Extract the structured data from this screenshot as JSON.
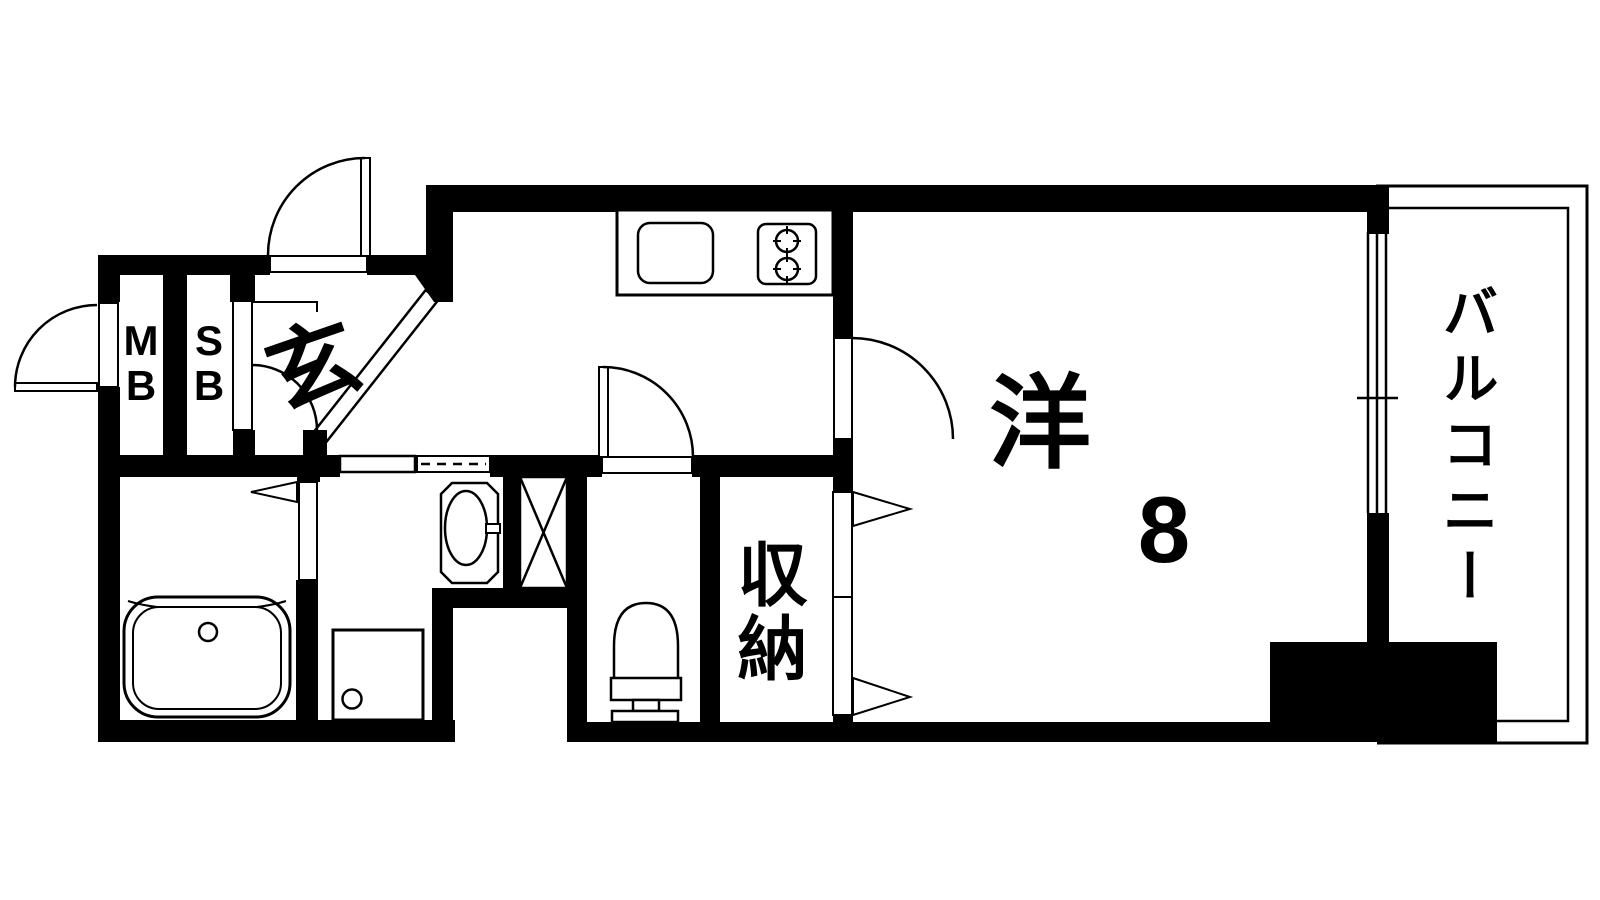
{
  "plan": {
    "colors": {
      "wall": "#000000",
      "bg": "#ffffff"
    },
    "labels": {
      "entrance": "玄",
      "meter_box": "M\nB",
      "shoe_box": "S\nB",
      "western_room": "洋",
      "western_room_size": "8",
      "storage": "収納",
      "balcony": "バルコニー"
    }
  }
}
